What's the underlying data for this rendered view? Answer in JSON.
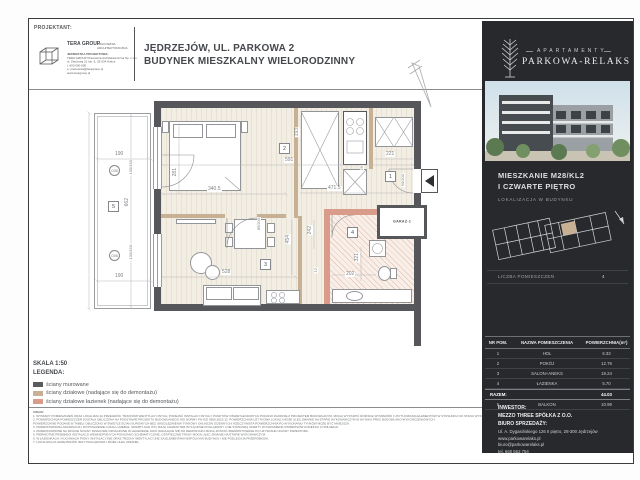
{
  "header": {
    "projektant": "PROJEKTANT:",
    "title_line1": "JĘDRZEJÓW, UL. PARKOWA 2",
    "title_line2": "BUDYNEK MIESZKALNY WIELORODZINNY",
    "designer": {
      "name": "TERA GROUP",
      "tagline1": "PRACOWNIA",
      "tagline2": "ARCHITEKTONICZNA",
      "lines": [
        "JEDNOSTKA PROJEKTOWA:",
        "TERA GROUP Pracownia Architektoniczna Sp. z o.o.",
        "ul. Zbożowa 21 lok. 6, 25-034 Kielce",
        "t. 600 000 000",
        "e. pracownia@teragroup.pl",
        "www.teragroup.pl"
      ]
    }
  },
  "brand": {
    "kicker": "APARTAMENTY",
    "name": "PARKOWA-RELAKS"
  },
  "unit": {
    "name": "MIESZKANIE M28/KL2",
    "floor": "I CZWARTE PIĘTRO",
    "location_label": "LOKALIZACJA W BUDYNKU",
    "rooms_label": "LICZBA POMIESZCZEŃ",
    "rooms_value": "4"
  },
  "table": {
    "headers": [
      "NR POM.",
      "NAZWA POMIESZCZENIA",
      "POWIERZCHNIA(m²)"
    ],
    "rows": [
      [
        "1",
        "HOL",
        "6.33"
      ],
      [
        "2",
        "POKÓJ",
        "12.76"
      ],
      [
        "3",
        "SALON+ANEKS",
        "19.24"
      ],
      [
        "4",
        "ŁAZIENKA",
        "5.70"
      ]
    ],
    "total_label": "RAZEM:",
    "total_value": "44.03",
    "balkon_row": [
      "5",
      "BALKON",
      "10.99"
    ]
  },
  "investor": {
    "label": "INWESTOR:",
    "company": "MEZZO THREE SPÓŁKA Z O.O.",
    "office_label": "BIURO SPRZEDAŻY:",
    "address": "Ul. A. Dygasińskiego 126 II piętro, 28-300 Jędrzejów",
    "www": "www.parkowarelaks.pl",
    "email": "biuro@parkowarelaks.pl",
    "phone": "tel. 660 562 754"
  },
  "legend": {
    "scale": "SKALA 1:50",
    "title": "LEGENDA:",
    "items": [
      {
        "label": "ściany murowane",
        "color": "#595b5e"
      },
      {
        "label": "ściany działowe (nadające się do demontażu)",
        "color": "#c7b094"
      },
      {
        "label": "ściany działowe łazienek (nadające się do demontażu)",
        "color": "#d99c8b"
      }
    ]
  },
  "notes": {
    "title": "UWAGI:",
    "lines": [
      "1. WYMIARY POMIESZCZEŃ ORAZ LOKALIZACJA PRZEGRÓD, TRZONÓW WENTYLACYJNYCH, PODEJŚĆ INSTALACYJNYCH I PUNKTÓW OŚWIETLENIOWYCH PODANO ZGODNIE Z PROJEKTEM BUDOWLANYM. MOGĄ WYSTĄPIĆ RÓŻNICE WYMIARÓW I USYTUOWANIA ELEMENTÓW W STOSUNKU DO STANU WYKONAWCZEGO.",
      "2. POWIERZCHNIA POMIESZCZEŃ ZOSTAŁA OBLICZONA NA PODSTAWIE PROJEKTU BUDOWLANEGO WG NORMY PN-ISO 9836:2015-12. POWIERZCHNIA UŻYTKOWA LOKALU MOŻE ULEC ZMIANIE NA ETAPIE WYKONAWCZYM W WYNIKU PRAC BUDOWLANO-WYKOŃCZENIOWYCH.",
      "POWIERZCHNIE PODANE W TABELI OBLICZONO W ŚWIETLE ŚCIAN SUROWYCH BEZ UWZGLĘDNIENIA TYNKÓW I OKŁADZIN ŚCIENNYCH; RZECZYWISTA POWIERZCHNIA PO WYKONANIU TYNKÓW MOŻE BYĆ MNIEJSZA.",
      "3. PRZEDSTAWIONA ARANŻACJA I WYPOSAŻENIE LOKALU (MEBLE, SPRZĘT AGD ITP.) MAJĄ CHARAKTER WYŁĄCZNIE POGLĄDOWY I NIE STANOWIĄ OFERTY W ROZUMIENIU PRZEPISÓW KODEKSU CYWILNEGO.",
      "4. PRZEDSTAWIONE NA RZUCIE ŚCIANY DZIAŁOWE OZNACZONE W LEGENDZIE JAKO NADAJĄCE SIĘ DO DEMONTAŻU MOGĄ ZOSTAĆ ZDEMONTOWANE PO UZYSKANIU ZGODY INWESTORA.",
      "5. PIERWOTNE PRZEBIEGI INSTALACJI WEWNĘTRZNYCH POKAZANO SCHEMATYCZNIE; OSTATECZNE TRASY MOGĄ ULEC ZMIANIE NA ETAPIE WYKONAWCZYM.",
      "6. W ŁAZIENKACH I KUCHNIACH PIONY INSTALACYJNE ORAZ TRZONY WENTYLACYJNE SĄ ELEMENTAMI WSPÓLNYMI BUDYNKU I NIE PODLEGAJĄ PRZERÓBKOM.",
      "7. LOKALIZACJA GRZEJNIKÓW JEST POGLĄDOWA I MOŻE ULEC ZMIANIE."
    ]
  },
  "plan": {
    "rooms": {
      "r1": "1",
      "r2": "2",
      "r3": "3",
      "r4": "4",
      "r5": "5"
    },
    "garage": "GARAŻ-1",
    "dims": {
      "w591": "591",
      "w3405": "340.5",
      "h281": "281",
      "w190": "190",
      "h662": "662",
      "w221": "221",
      "w4715": "471.5",
      "w528": "528",
      "h454": "454",
      "h242": "242",
      "h321": "321",
      "w202": "202",
      "h193": "193",
      "t25": "25",
      "t12": "12",
      "door1": "90/200",
      "door2": "85/200",
      "win": "100/150",
      "marker": "O08"
    }
  },
  "colors": {
    "accent_tan": "#c7b094",
    "panel_bg": "#27292c",
    "wall_gray": "#55575a",
    "bath_wall": "#d99c8b"
  }
}
